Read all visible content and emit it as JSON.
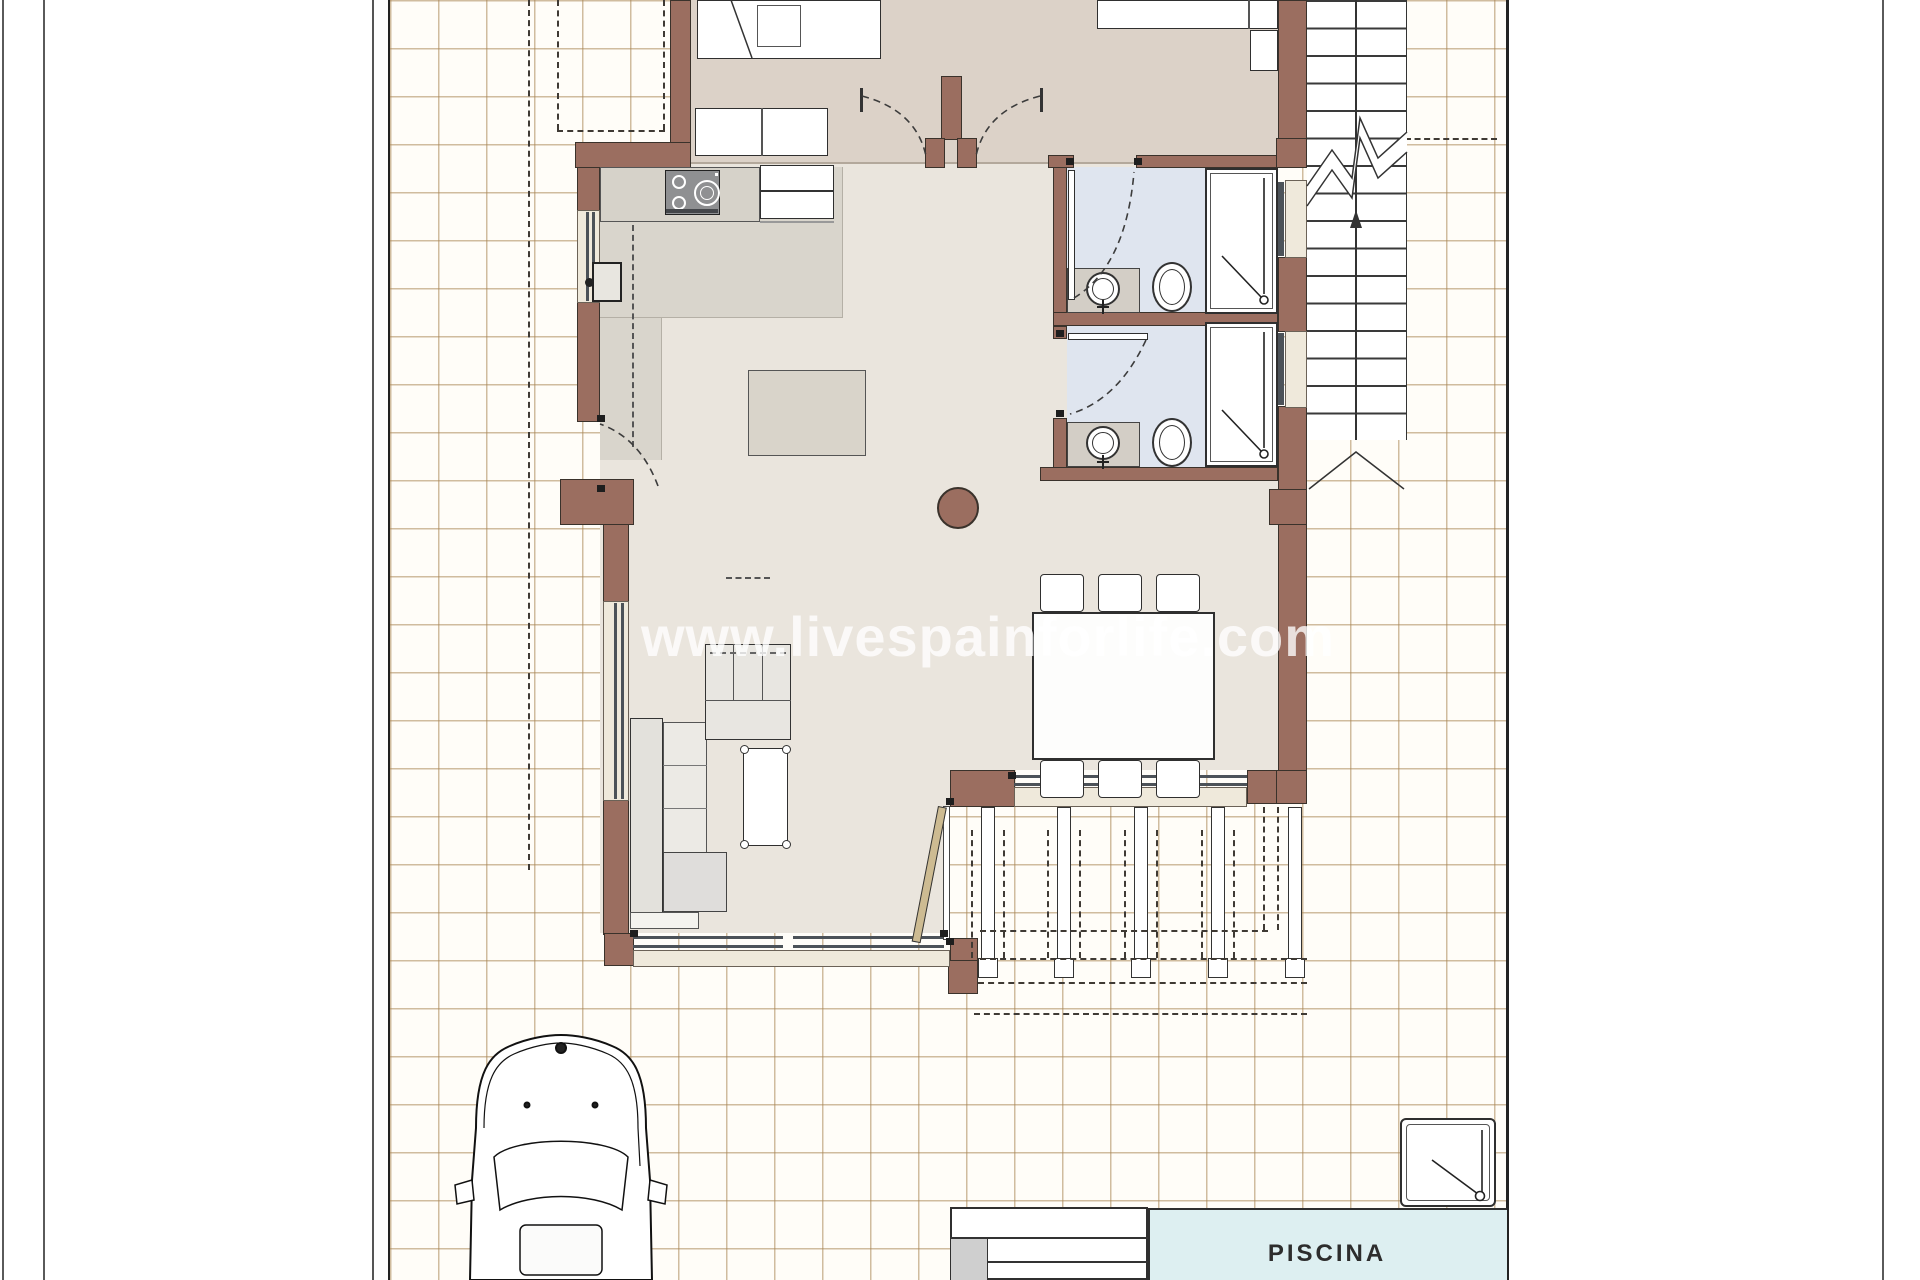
{
  "watermark": {
    "text": "www.livespainforlife.com"
  },
  "pool": {
    "label": "PISCINA"
  },
  "palette": {
    "wall": "#9b6e60",
    "tile_line": "#a98858",
    "bedroom_floor": "#dcd2c8",
    "living_floor": "#eae5dd",
    "kitchen_floor": "#d9d5cc",
    "bath_floor": "#dfe5ef",
    "counter": "#d6d2c9",
    "sill": "#efe9db",
    "glazing": "#4c5258",
    "pool_fill": "#ddeff1",
    "watermark_color": "rgba(255,255,255,0.78)"
  },
  "icons": {
    "stove": "stove-icon",
    "sink": "sink-icon",
    "toilet": "toilet-icon",
    "shower": "shower-icon",
    "outdoor_shower": "outdoor-shower-icon",
    "car": "car-icon",
    "stairs_arrow": "stairs-up-arrow-icon"
  }
}
